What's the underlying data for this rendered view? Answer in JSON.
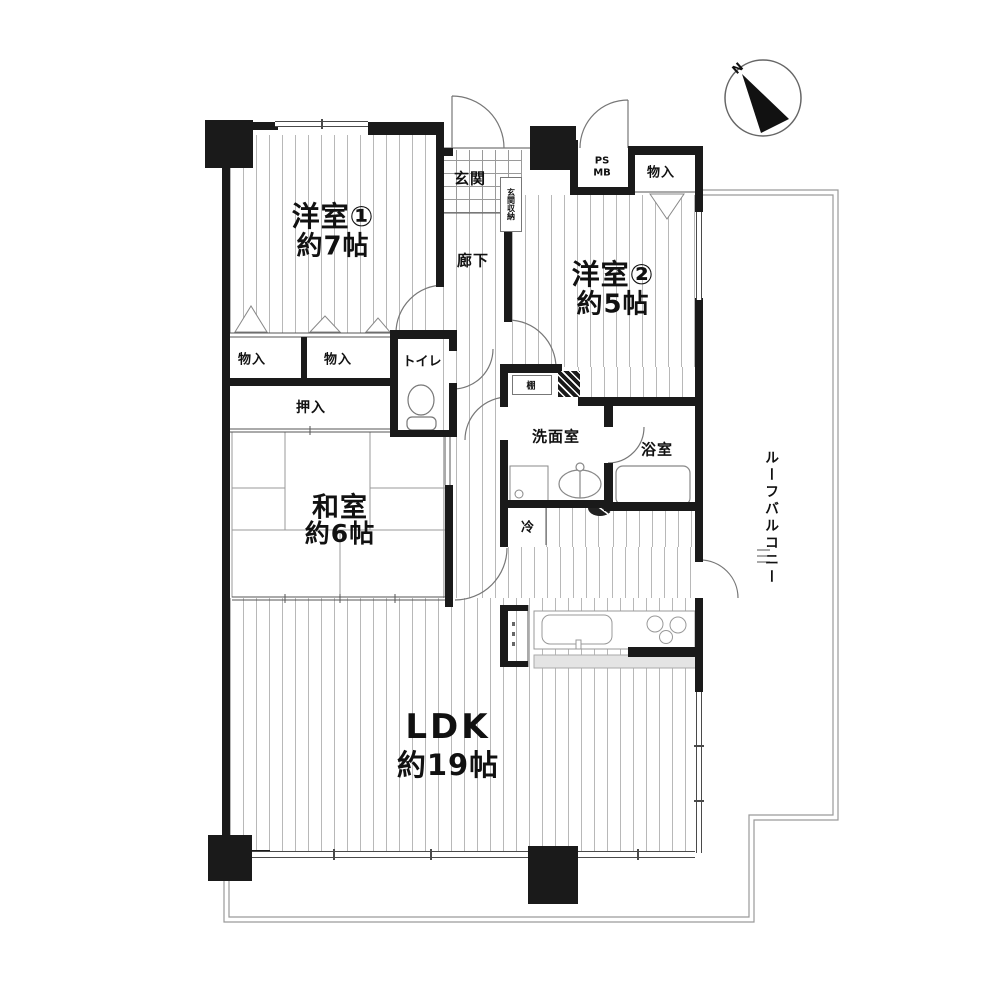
{
  "plan_title": "apartment-floor-plan",
  "compass": {
    "north_label": "N"
  },
  "rooms": {
    "yoshitsu1": {
      "name": "洋室①",
      "size": "約7帖"
    },
    "yoshitsu2": {
      "name": "洋室②",
      "size": "約5帖"
    },
    "washitsu": {
      "name": "和室",
      "size": "約6帖"
    },
    "ldk": {
      "name": "LDK",
      "size": "約19帖"
    },
    "genkan": {
      "label": "玄関"
    },
    "rouka": {
      "label": "廊下"
    },
    "toilet": {
      "label": "トイレ"
    },
    "senmenshitsu": {
      "label": "洗面室"
    },
    "yokushitsu": {
      "label": "浴室"
    },
    "roof_balcony": {
      "label": "ルーフバルコニー"
    }
  },
  "storage": {
    "monoire_a": "物入",
    "monoire_b": "物入",
    "monoire_c": "物入",
    "oshiire": "押入",
    "genkan_shunou": "玄関収納",
    "tana": "棚"
  },
  "fixtures": {
    "rei": "冷",
    "ps": "PS",
    "mb": "MB"
  },
  "colors": {
    "wall": "#1a1a1a",
    "floor_hatch": "#b8b8b8",
    "balcony_outline": "#999999",
    "counter_strip": "#e4e4e4"
  }
}
